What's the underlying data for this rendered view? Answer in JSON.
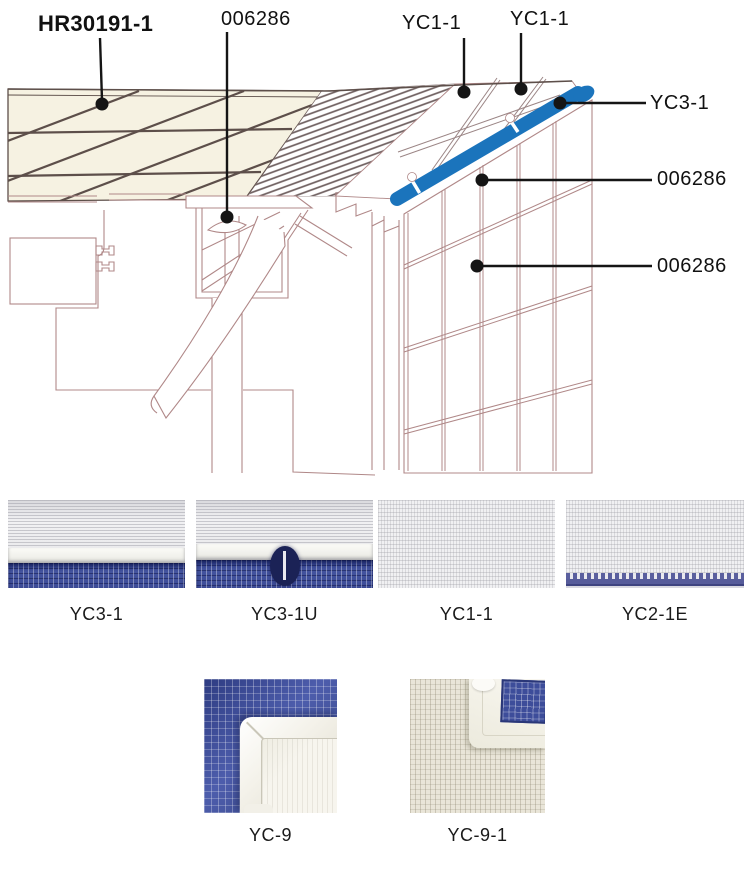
{
  "diagram": {
    "callouts": [
      {
        "id": "hr",
        "label": "HR30191-1"
      },
      {
        "id": "part-top",
        "label": "006286"
      },
      {
        "id": "yc1-a",
        "label": "YC1-1"
      },
      {
        "id": "yc1-b",
        "label": "YC1-1"
      },
      {
        "id": "yc3",
        "label": "YC3-1"
      },
      {
        "id": "part-mid",
        "label": "006286"
      },
      {
        "id": "part-low",
        "label": "006286"
      }
    ],
    "colors": {
      "trim_blue": "#1b74bc",
      "outline_pink": "#b08888",
      "tile_cream": "#f6f2e2",
      "joint_dark": "#5d4f4a",
      "leader_black": "#151515"
    }
  },
  "samples": {
    "row1": [
      {
        "label": "YC3-1"
      },
      {
        "label": "YC3-1U"
      },
      {
        "label": "YC1-1"
      },
      {
        "label": "YC2-1E"
      }
    ],
    "row2": [
      {
        "label": "YC-9"
      },
      {
        "label": "YC-9-1"
      }
    ]
  }
}
